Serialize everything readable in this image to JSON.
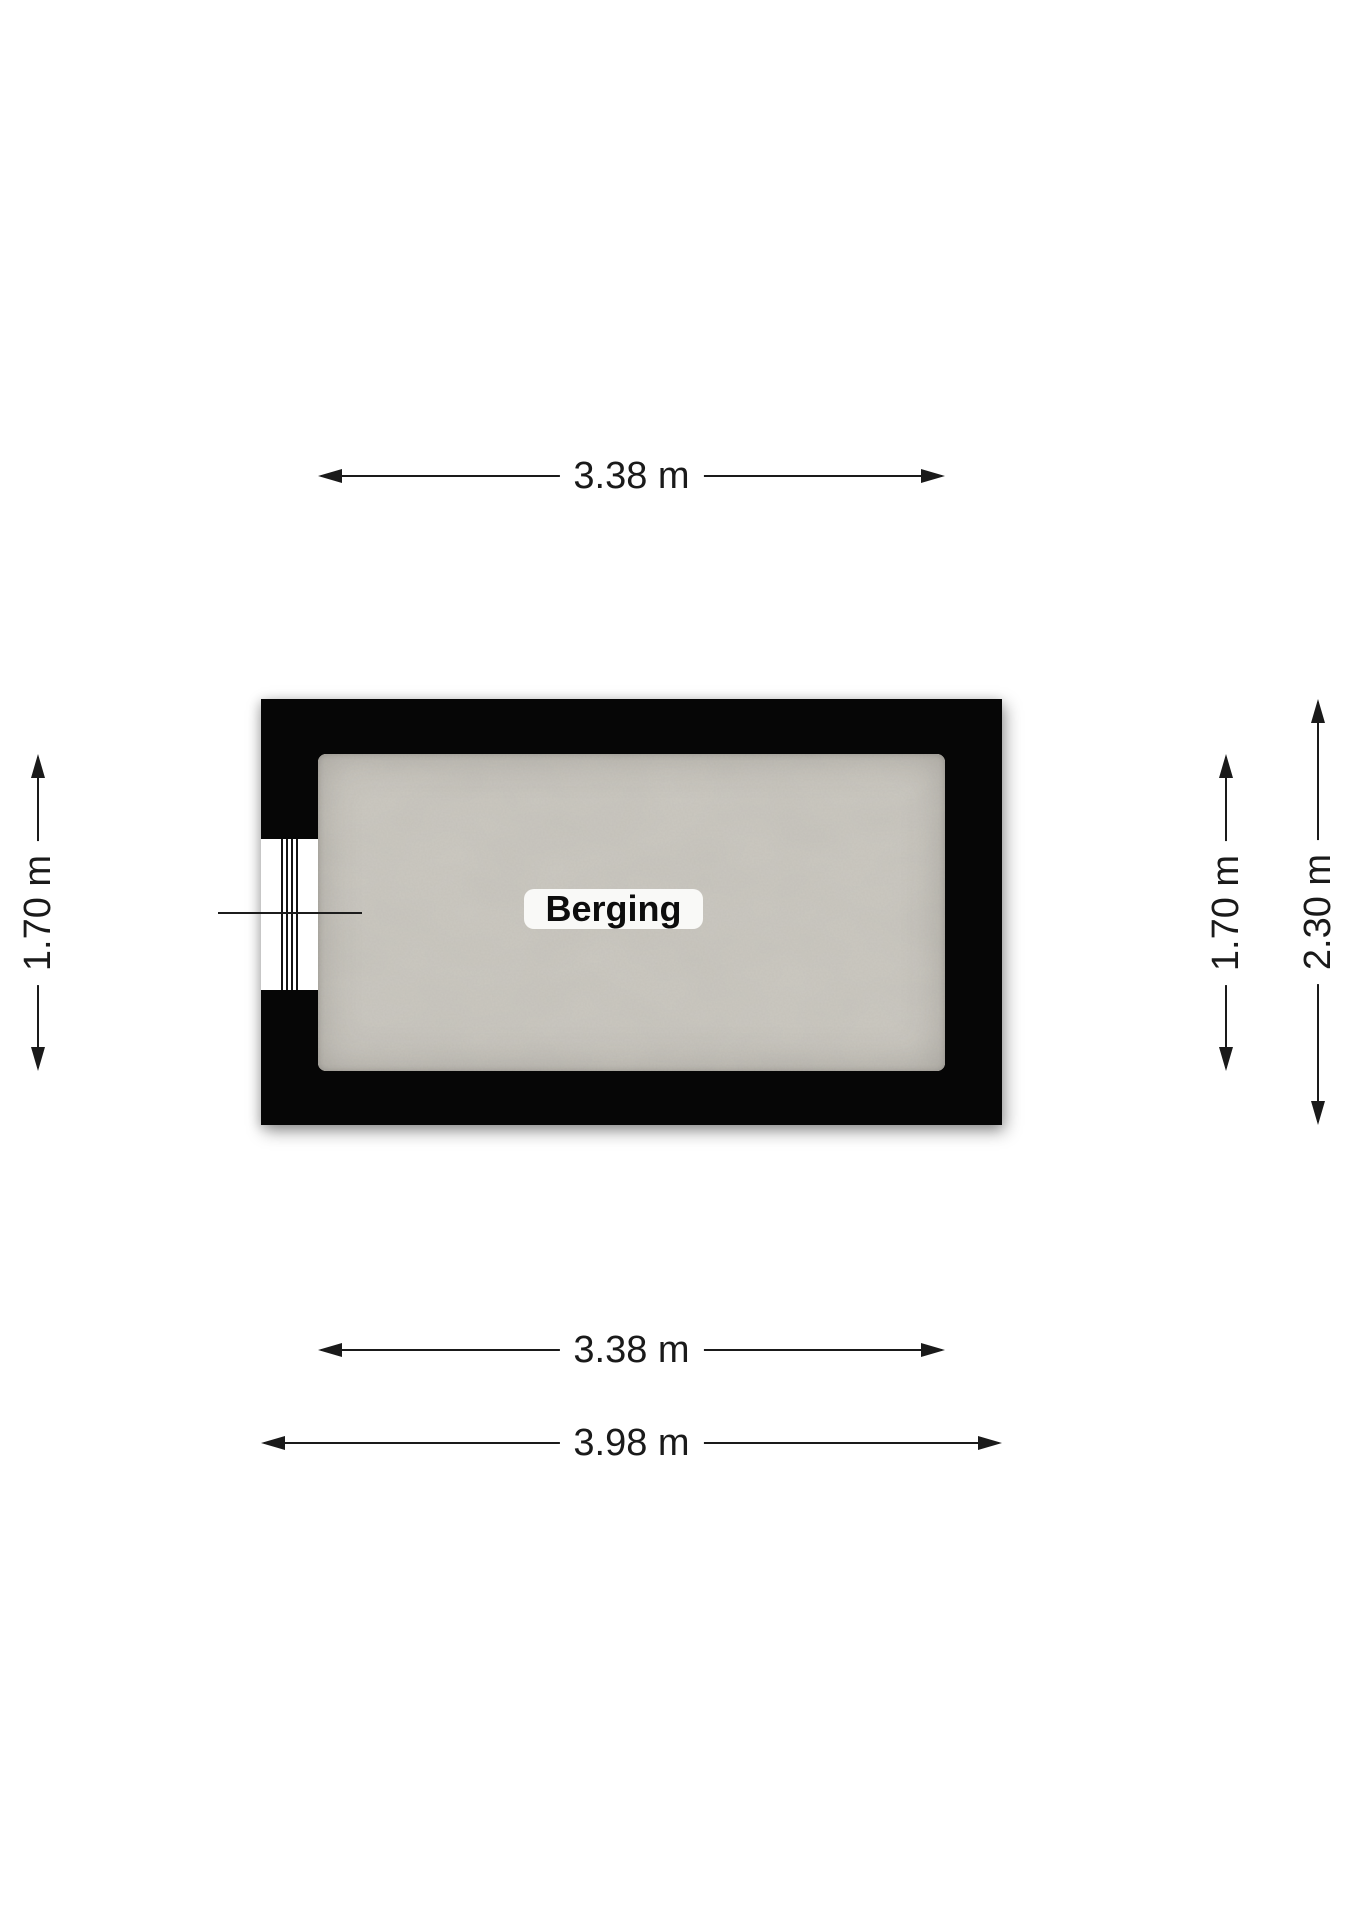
{
  "floorplan": {
    "room_label": "Berging",
    "dimensions": {
      "top_inner_width": "3.38 m",
      "bottom_inner_width": "3.38 m",
      "bottom_outer_width": "3.98 m",
      "left_inner_height": "1.70 m",
      "right_inner_height": "1.70 m",
      "right_outer_height": "2.30 m"
    },
    "colors": {
      "background": "#ffffff",
      "wall": "#060606",
      "floor": "#ccc9c1",
      "dimension_line": "#1a1a1a",
      "room_label_bg": "#f9f9f7"
    }
  }
}
